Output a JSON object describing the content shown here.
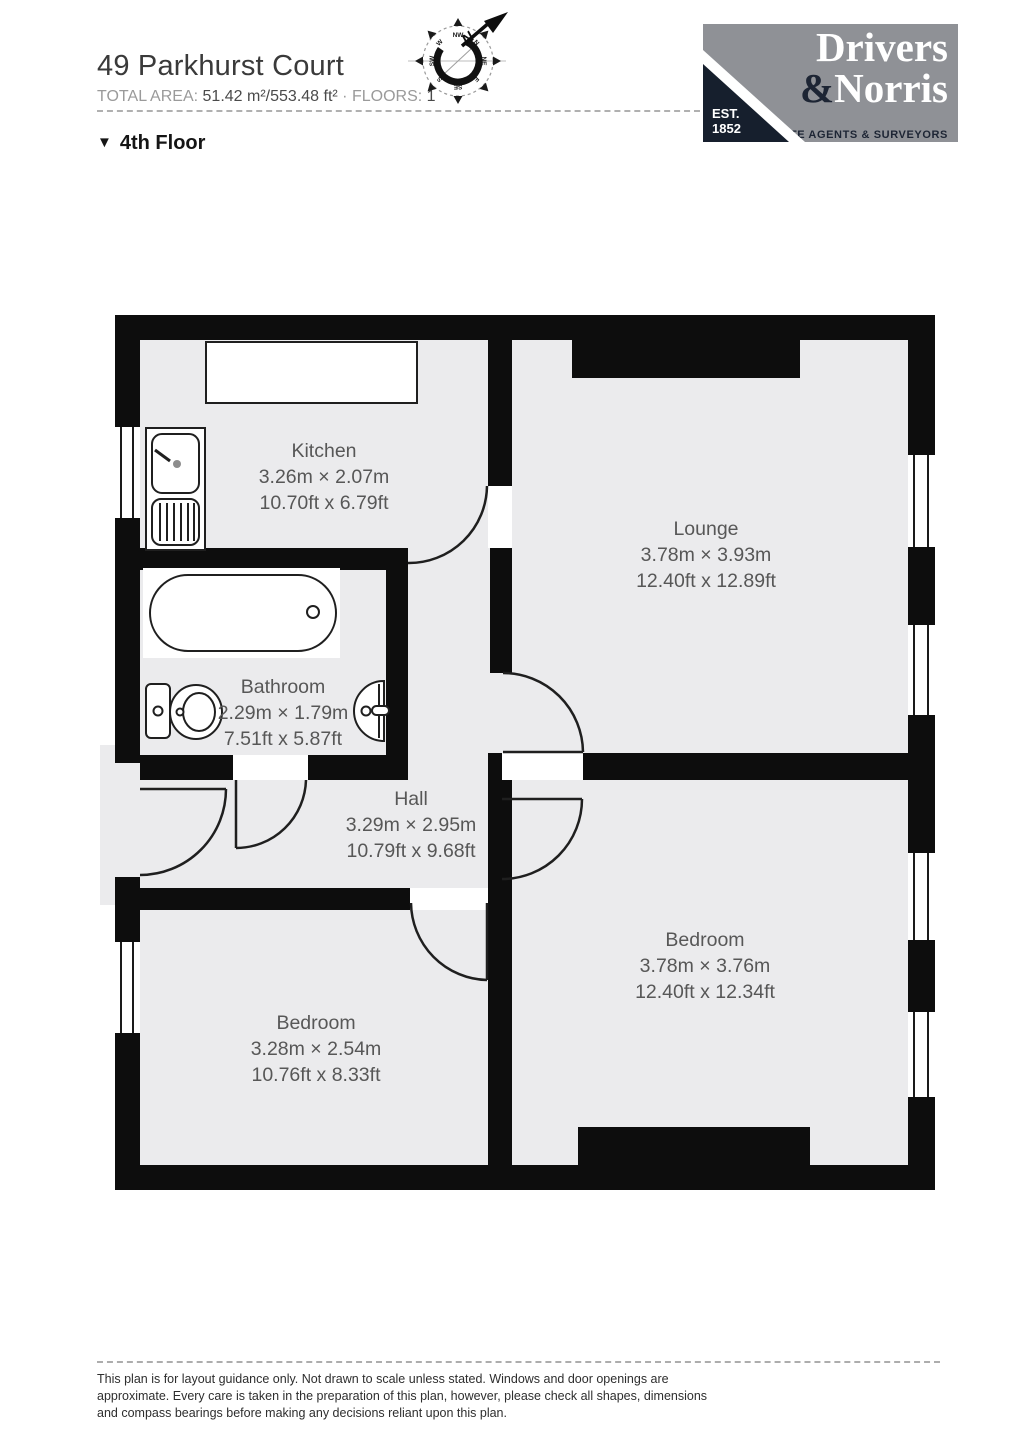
{
  "header": {
    "title": "49 Parkhurst Court",
    "total_area_label": "TOTAL AREA:",
    "total_area_value": "51.42 m²/553.48 ft²",
    "separator": "·",
    "floors_label": "FLOORS:",
    "floors_value": "1",
    "floor_marker": "▼",
    "floor_name": "4th Floor"
  },
  "compass": {
    "north_label": "N",
    "points": [
      "N",
      "NE",
      "E",
      "SE",
      "S",
      "SW",
      "W",
      "NW"
    ]
  },
  "logo": {
    "line1": "Drivers",
    "amp": "&",
    "line2": "Norris",
    "tagline": "ESTATE AGENTS & SURVEYORS",
    "est_label": "EST.",
    "est_year": "1852"
  },
  "rooms": {
    "kitchen": {
      "name": "Kitchen",
      "dims_m": "3.26m × 2.07m",
      "dims_ft": "10.70ft x 6.79ft"
    },
    "lounge": {
      "name": "Lounge",
      "dims_m": "3.78m × 3.93m",
      "dims_ft": "12.40ft x 12.89ft"
    },
    "bathroom": {
      "name": "Bathroom",
      "dims_m": "2.29m × 1.79m",
      "dims_ft": "7.51ft x 5.87ft"
    },
    "hall": {
      "name": "Hall",
      "dims_m": "3.29m × 2.95m",
      "dims_ft": "10.79ft x 9.68ft"
    },
    "bedroom_right": {
      "name": "Bedroom",
      "dims_m": "3.78m × 3.76m",
      "dims_ft": "12.40ft x 12.34ft"
    },
    "bedroom_left": {
      "name": "Bedroom",
      "dims_m": "3.28m × 2.54m",
      "dims_ft": "10.76ft x 8.33ft"
    }
  },
  "footer": {
    "line1": "This plan is for layout guidance only. Not drawn to scale unless stated. Windows and door openings are",
    "line2": "approximate. Every care is taken in the preparation of this plan, however, please check all shapes, dimensions",
    "line3": "and compass bearings before making any decisions reliant upon this plan."
  },
  "colors": {
    "wall": "#0d0d0d",
    "floor": "#ebebed",
    "label": "#575757",
    "logo_bg": "#8f9196",
    "logo_navy": "#1d2534"
  }
}
